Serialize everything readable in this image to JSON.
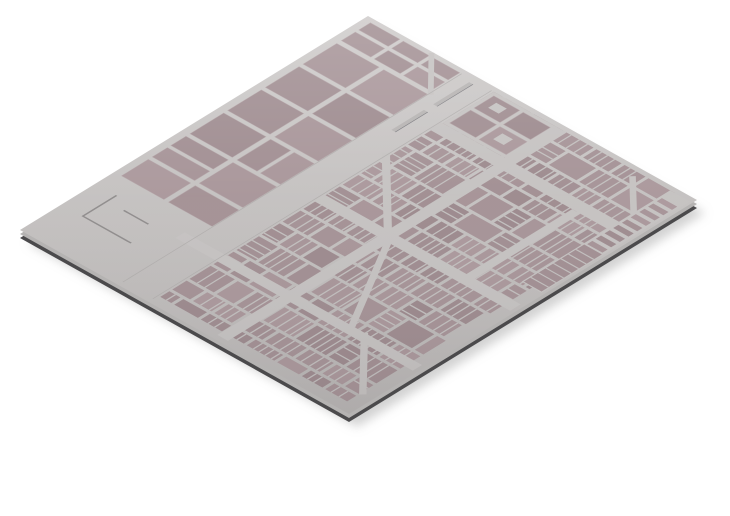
{
  "viewport": {
    "width": 730,
    "height": 516,
    "viewBox": "0 0 730 516",
    "background": "#ffffff"
  },
  "scene": {
    "kind": "isometric-3d-city-map-plate"
  },
  "projection": {
    "origin": [
      368,
      16
    ],
    "x_axis": [
      329,
      184
    ],
    "y_axis": [
      -348,
      214
    ],
    "map_width": 560,
    "map_height": 600,
    "side_offsets": [
      4,
      8
    ],
    "shadow_offset": [
      8,
      13
    ]
  },
  "palette": {
    "street_light": "#cdcac9",
    "street_dark": "#b7b4b3",
    "street_flat": "#c4c1c0",
    "street_thin": "#c1bebd",
    "block_base": [
      162,
      143,
      147
    ],
    "block_stroke": "#b3a4a7",
    "side_light": "#b5b3b2",
    "side_dark": "#4b4a4c",
    "shadow": "#9c9c9c",
    "shadow_opacity": 0.45,
    "median_fill": "#b5b2b1",
    "median_edge": "#76757a",
    "mark_stroke": "#8d8a8a",
    "curb": "#b0adac"
  },
  "layout": {
    "seed": 11,
    "large_blocks": [
      [
        12,
        66,
        72,
        58
      ],
      [
        92,
        66,
        74,
        58
      ],
      [
        12,
        131,
        72,
        58
      ],
      [
        92,
        131,
        74,
        58
      ],
      [
        12,
        196,
        72,
        58
      ],
      [
        92,
        196,
        74,
        58
      ],
      [
        12,
        261,
        72,
        58
      ],
      [
        92,
        261,
        34,
        58
      ],
      [
        132,
        261,
        34,
        58
      ],
      [
        12,
        326,
        72,
        26
      ],
      [
        12,
        358,
        72,
        26
      ],
      [
        92,
        326,
        74,
        58
      ],
      [
        12,
        391,
        72,
        46
      ],
      [
        92,
        391,
        74,
        46
      ]
    ],
    "top_blocks": [
      [
        12,
        8,
        50,
        20
      ],
      [
        68,
        8,
        44,
        20
      ],
      [
        118,
        8,
        46,
        20
      ],
      [
        12,
        34,
        50,
        24
      ],
      [
        68,
        34,
        44,
        24
      ],
      [
        118,
        34,
        46,
        24
      ]
    ],
    "top_diagonal": {
      "x1": 110,
      "y1": 2,
      "x2": 170,
      "y2": 64,
      "w": 7
    },
    "boulevard": {
      "curbs": [
        166.5,
        217.5
      ],
      "medians": [
        [
          186,
          14,
          6,
          62
        ],
        [
          186,
          92,
          6,
          56
        ]
      ]
    },
    "dense": {
      "region": [
        222,
        8,
        540,
        588
      ],
      "street": 5,
      "row_min": 26,
      "row_max": 44,
      "block_min": 30,
      "block_max": 58,
      "sliver_w": 2.2,
      "sliver_gap_min": 9,
      "sliver_gap_max": 15,
      "plain_chance": 0.22
    },
    "major_streets": [
      [
        218,
        96,
        336,
        20
      ],
      [
        328,
        8,
        18,
        584
      ],
      [
        218,
        298,
        336,
        18
      ],
      [
        150,
        468,
        404,
        16
      ],
      [
        462,
        116,
        14,
        192
      ]
    ],
    "diagonal_streets": [
      {
        "x1": 214,
        "y1": 186,
        "x2": 332,
        "y2": 302,
        "w": 10
      },
      {
        "x1": 346,
        "y1": 316,
        "x2": 436,
        "y2": 470,
        "w": 9
      },
      {
        "x1": 468,
        "y1": 18,
        "x2": 550,
        "y2": 98,
        "w": 8
      },
      {
        "x1": 456,
        "y1": 468,
        "x2": 544,
        "y2": 560,
        "w": 9
      }
    ],
    "courtyard": {
      "zone": [
        222,
        8,
        108,
        88
      ],
      "blocks": [
        [
          228,
          14,
          44,
          34
        ],
        [
          278,
          14,
          46,
          34
        ],
        [
          228,
          54,
          44,
          36
        ],
        [
          278,
          54,
          46,
          36
        ]
      ],
      "holes": [
        [
          240,
          22,
          18,
          14
        ],
        [
          290,
          62,
          18,
          16
        ]
      ]
    },
    "piers": {
      "zone": [
        522,
        8,
        34,
        256
      ],
      "start": 26,
      "step": 15,
      "end": 148,
      "item": [
        526,
        26,
        9
      ],
      "long_block": [
        524,
        158,
        30,
        104
      ],
      "long_sliver_step": 13
    },
    "plaza_marks": {
      "polyline": [
        [
          36,
          470
        ],
        [
          36,
          528
        ],
        [
          118,
          528
        ]
      ],
      "line": [
        [
          64,
          486
        ],
        [
          106,
          486
        ]
      ]
    }
  }
}
